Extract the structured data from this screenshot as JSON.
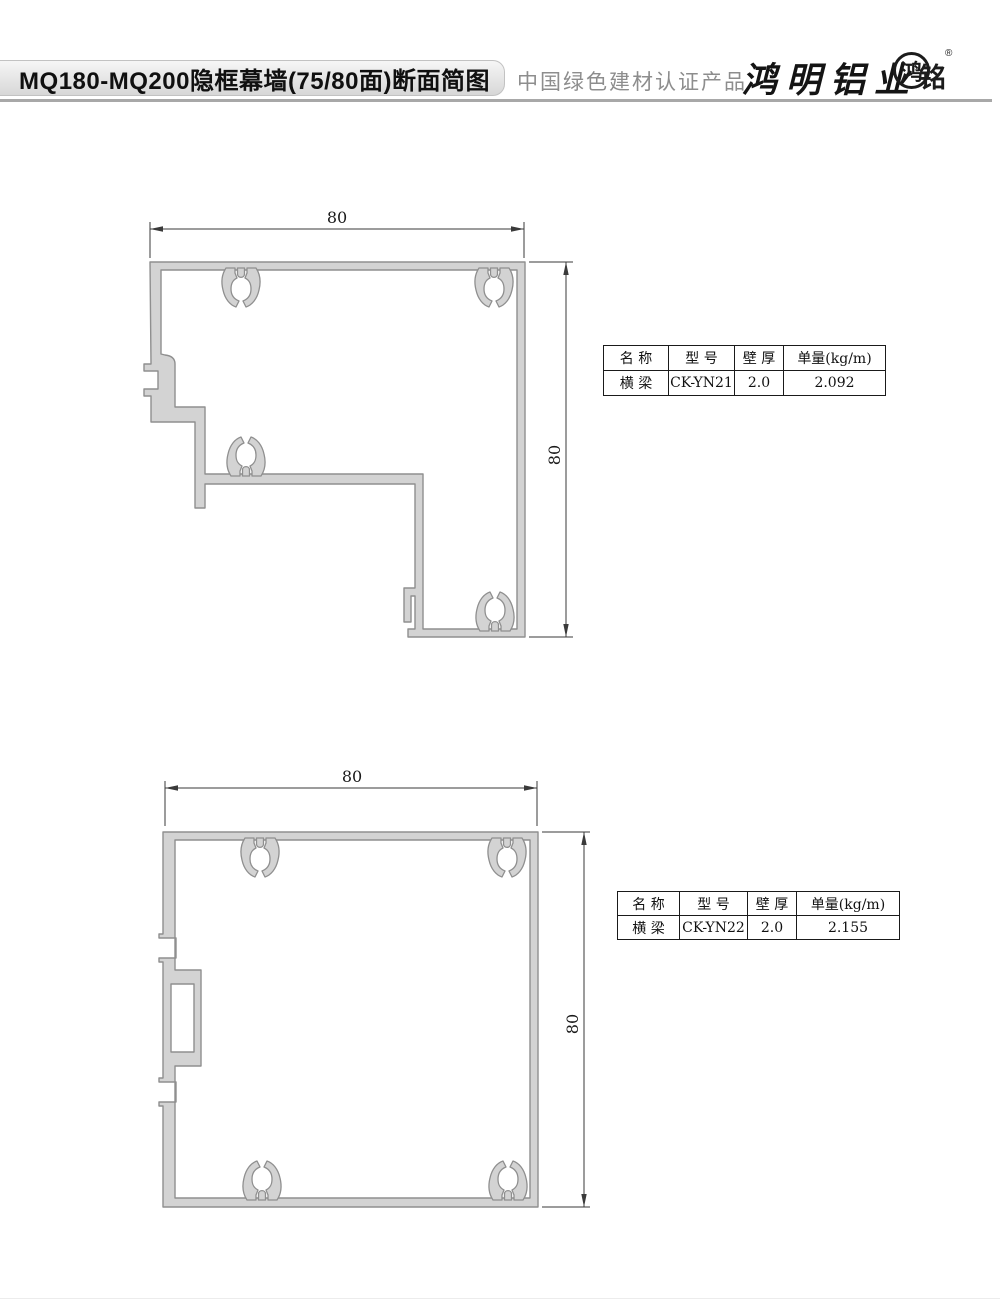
{
  "header": {
    "title": "MQ180-MQ200隐框幕墙(75/80面)断面简图",
    "certification": "中国绿色建材认证产品",
    "brand": "鸿明铝业",
    "seal_inner": "鸿",
    "seal_outer": "铭",
    "registered": "®"
  },
  "drawings": [
    {
      "name": "corner-mullion-section",
      "width_label": "80",
      "height_label": "80"
    },
    {
      "name": "square-mullion-section",
      "width_label": "80",
      "height_label": "80"
    }
  ],
  "tables": [
    {
      "headers": [
        "名 称",
        "型 号",
        "壁 厚",
        "单量(kg/m)"
      ],
      "rows": [
        [
          "横 梁",
          "CK-YN21",
          "2.0",
          "2.092"
        ]
      ]
    },
    {
      "headers": [
        "名 称",
        "型 号",
        "壁 厚",
        "单量(kg/m)"
      ],
      "rows": [
        [
          "横 梁",
          "CK-YN22",
          "2.0",
          "2.155"
        ]
      ]
    }
  ],
  "colors": {
    "profile_fill": "#d3d3d3",
    "profile_stroke": "#8f8f8f",
    "dim_line": "#3a3a3a",
    "table_border": "#1a1a1a"
  }
}
